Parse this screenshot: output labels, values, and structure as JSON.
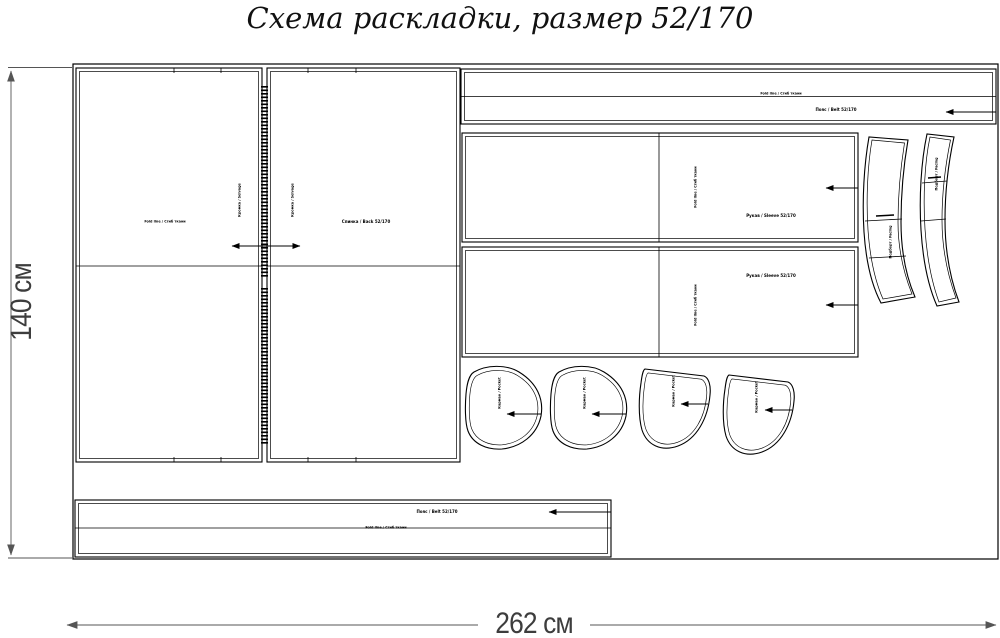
{
  "title": "Схема раскладки, размер 52/170",
  "fabric": {
    "height_label": "140 см",
    "width_label": "262 см"
  },
  "labels": {
    "fold_line": "Fold line / Сгиб ткани",
    "selvage": "Кромка / Selvage",
    "back_name": "Спинка / Back 52/170",
    "belt_name": "Пояс / Belt 52/170",
    "sleeve_name": "Рукав / Sleeve 52/170",
    "pocket_name": "Карман / Pocket",
    "facing_name": "Подборт / Facing"
  },
  "colors": {
    "line": "#000000",
    "dimension": "#555555",
    "background": "#ffffff"
  }
}
